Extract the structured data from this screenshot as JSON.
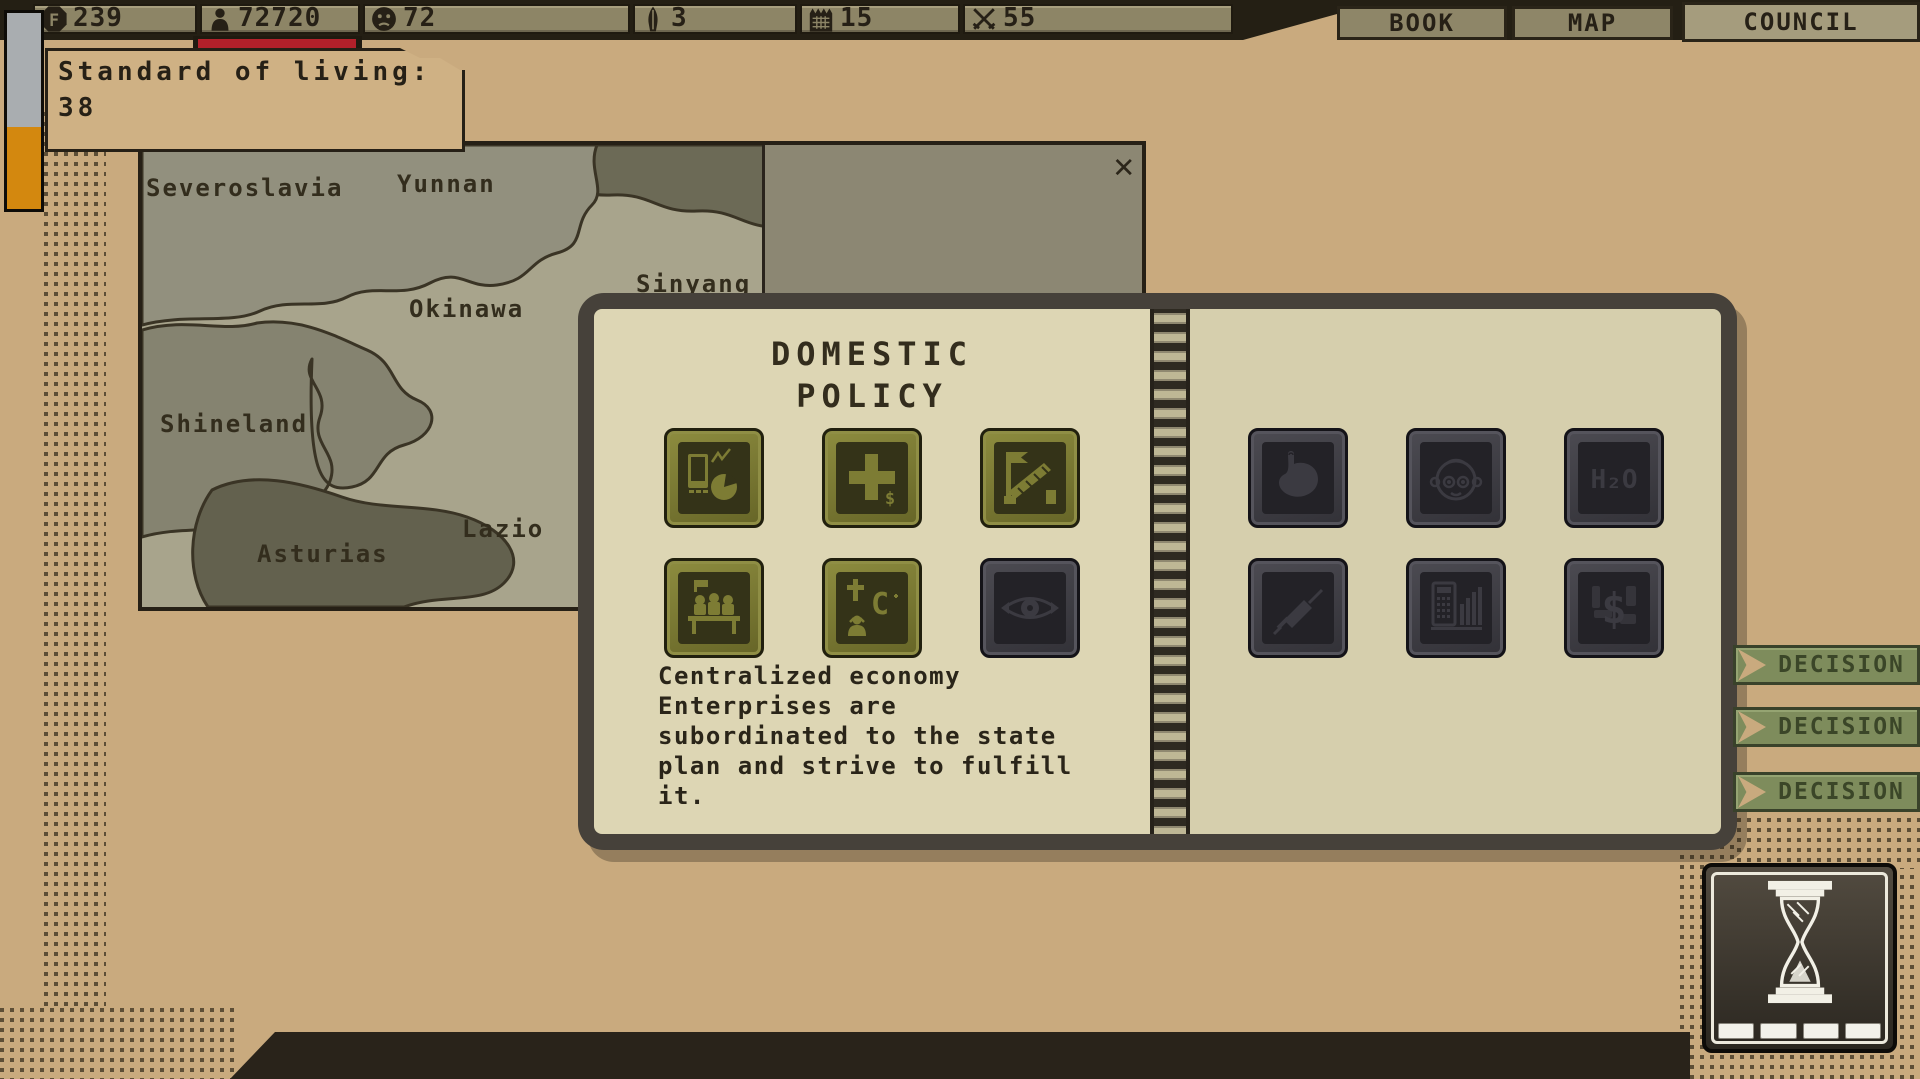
{
  "palette": {
    "background_tan": "#c9aa7e",
    "bar_khaki": "#8d8566",
    "ink_dark": "#262016",
    "progress_red": "#b2202a",
    "gauge_orange": "#d3880f",
    "gauge_gray": "#a9adb0",
    "olive_button": "#7b7a31",
    "page_cream": "#ddd6b4",
    "decision_green": "#7e8c5c"
  },
  "top_bar": {
    "stats": [
      {
        "icon": "coin-f-icon",
        "value": "239"
      },
      {
        "icon": "population-icon",
        "value": "72720"
      },
      {
        "icon": "mood-face-icon",
        "value": "72"
      },
      {
        "icon": "missile-icon",
        "value": "3"
      },
      {
        "icon": "calendar-icon",
        "value": "15"
      },
      {
        "icon": "crossed-swords-icon",
        "value": "55"
      }
    ],
    "tabs": [
      {
        "label": "BOOK"
      },
      {
        "label": "MAP"
      },
      {
        "label": "COUNCIL"
      }
    ]
  },
  "tooltip": {
    "title": "Standard of living:",
    "value": "38"
  },
  "map": {
    "close_label": "✕",
    "regions": [
      {
        "name": "Severoslavia"
      },
      {
        "name": "Yunnan"
      },
      {
        "name": "Sinyang"
      },
      {
        "name": "Okinawa"
      },
      {
        "name": "Shineland"
      },
      {
        "name": "Lazio"
      },
      {
        "name": "Asturias"
      }
    ]
  },
  "policy_book": {
    "title_line1": "DOMESTIC",
    "title_line2": "POLICY",
    "left_icons": [
      {
        "name": "economy-icon",
        "style": "olive"
      },
      {
        "name": "budget-plus-icon",
        "style": "olive",
        "glyph_text": "$"
      },
      {
        "name": "border-checkpoint-icon",
        "style": "olive"
      },
      {
        "name": "assembly-icon",
        "style": "olive"
      },
      {
        "name": "religion-icon",
        "style": "olive",
        "glyph_text": "C"
      },
      {
        "name": "surveillance-eye-icon",
        "style": "dark"
      }
    ],
    "right_icons": [
      {
        "name": "stomach-icon",
        "style": "dark"
      },
      {
        "name": "child-icon",
        "style": "dark"
      },
      {
        "name": "water-icon",
        "style": "dark",
        "glyph_text": "H₂O"
      },
      {
        "name": "syringe-icon",
        "style": "dark"
      },
      {
        "name": "statistics-icon",
        "style": "dark"
      },
      {
        "name": "finance-icon",
        "style": "dark",
        "glyph_text": "$"
      }
    ],
    "description_lines": [
      "Centralized economy",
      "Enterprises are",
      "subordinated to the state",
      "plan and strive to fulfill",
      "it."
    ]
  },
  "decisions": [
    {
      "label": "DECISION"
    },
    {
      "label": "DECISION"
    },
    {
      "label": "DECISION"
    }
  ],
  "time_control": {
    "icon": "hourglass-icon",
    "segments": 4
  }
}
